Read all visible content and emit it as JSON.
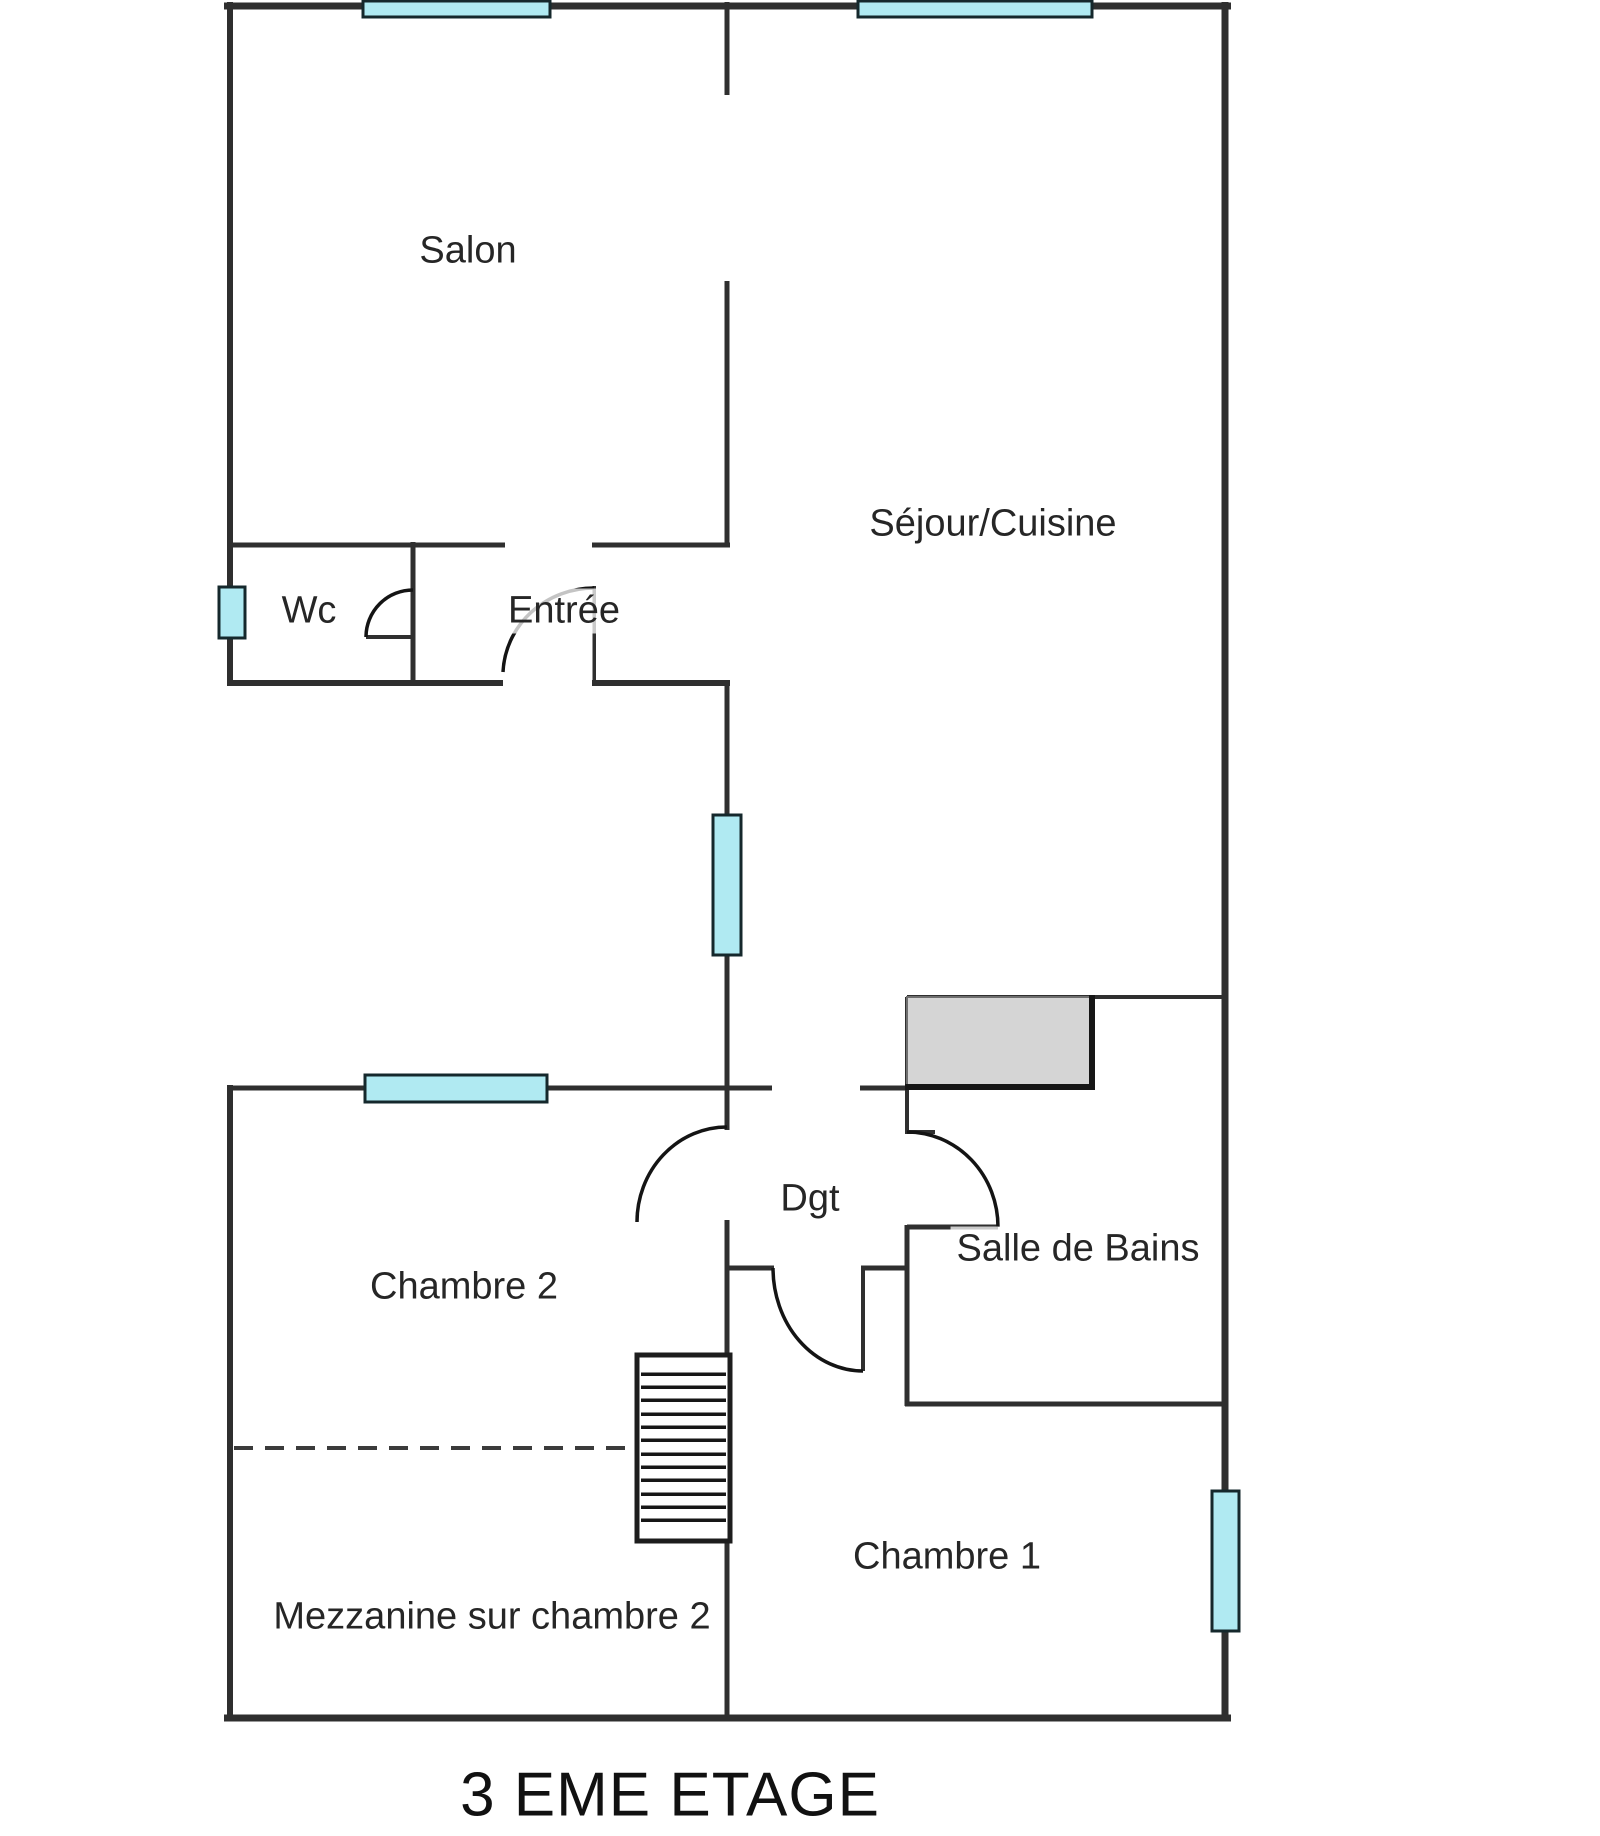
{
  "title": "3 EME ETAGE",
  "colors": {
    "wall": "#2f2f2f",
    "window_fill": "#b0eaf2",
    "window_border": "#15282c",
    "fixture_fill": "#d5d5d5",
    "dash": "#3b3b3b",
    "text": "#262626"
  },
  "rooms": [
    {
      "id": "salon",
      "label": "Salon"
    },
    {
      "id": "sejour-cuisine",
      "label": "Séjour/Cuisine"
    },
    {
      "id": "wc",
      "label": "Wc"
    },
    {
      "id": "entree",
      "label": "Entrée"
    },
    {
      "id": "dgt",
      "label": "Dgt"
    },
    {
      "id": "salle-de-bains",
      "label": "Salle de Bains"
    },
    {
      "id": "chambre-2",
      "label": "Chambre 2"
    },
    {
      "id": "chambre-1",
      "label": "Chambre 1"
    },
    {
      "id": "mezzanine",
      "label": "Mezzanine sur chambre 2"
    }
  ]
}
